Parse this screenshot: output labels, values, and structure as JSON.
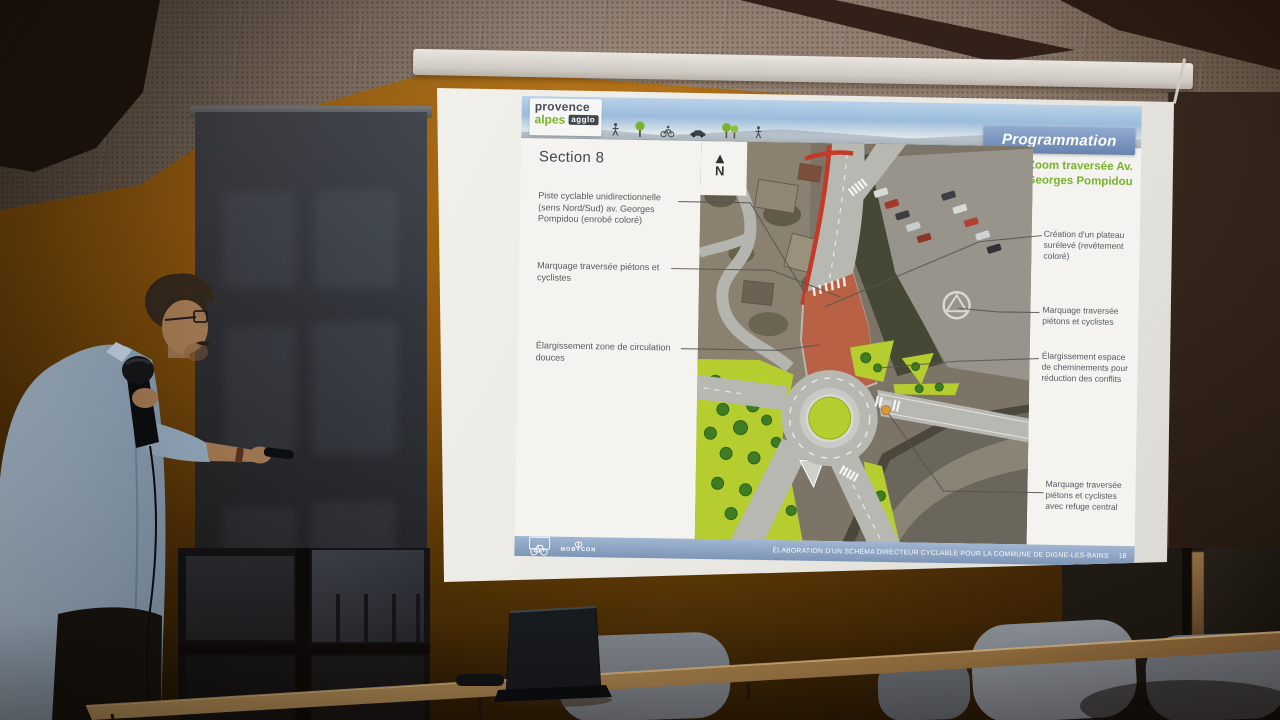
{
  "slide": {
    "logo": {
      "line1": "provence",
      "line2": "alpes",
      "badge": "agglo"
    },
    "banner": "Programmation",
    "section_title": "Section 8",
    "north_label": "N",
    "zoom_title": "Zoom traversée Av. Georges Pompidou",
    "header_icons": [
      "pedestrian-icon",
      "tree-icon",
      "cyclist-icon",
      "car-icon",
      "trees-icon",
      "pedestrian-icon"
    ],
    "left_labels": [
      "Piste cyclable unidirectionnelle (sens Nord/Sud) av. Georges Pompidou (enrobé coloré)",
      "Marquage traversée piétons et cyclistes",
      "Élargissement zone de circulation douces"
    ],
    "right_labels": [
      "Création d'un plateau surélevé (revêtement coloré)",
      "Marquage traversée piétons et cyclistes",
      "Élargissement espace de cheminements pour réduction des conflits",
      "Marquage traversée piétons et cyclistes avec refuge central"
    ],
    "footer": {
      "partner": "MOBYCON",
      "title": "ÉLABORATION D'UN SCHÉMA DIRECTEUR CYCLABLE POUR LA COMMUNE DE DIGNE-LES-BAINS",
      "page": "18"
    },
    "colors": {
      "accent_green": "#79b22b",
      "banner_blue": "#7292c2",
      "footer_blue": "#8ba6c9",
      "cycle_red": "#c23a28",
      "map_green": "#b6cd2f",
      "plateau_brick": "#b86144"
    }
  }
}
